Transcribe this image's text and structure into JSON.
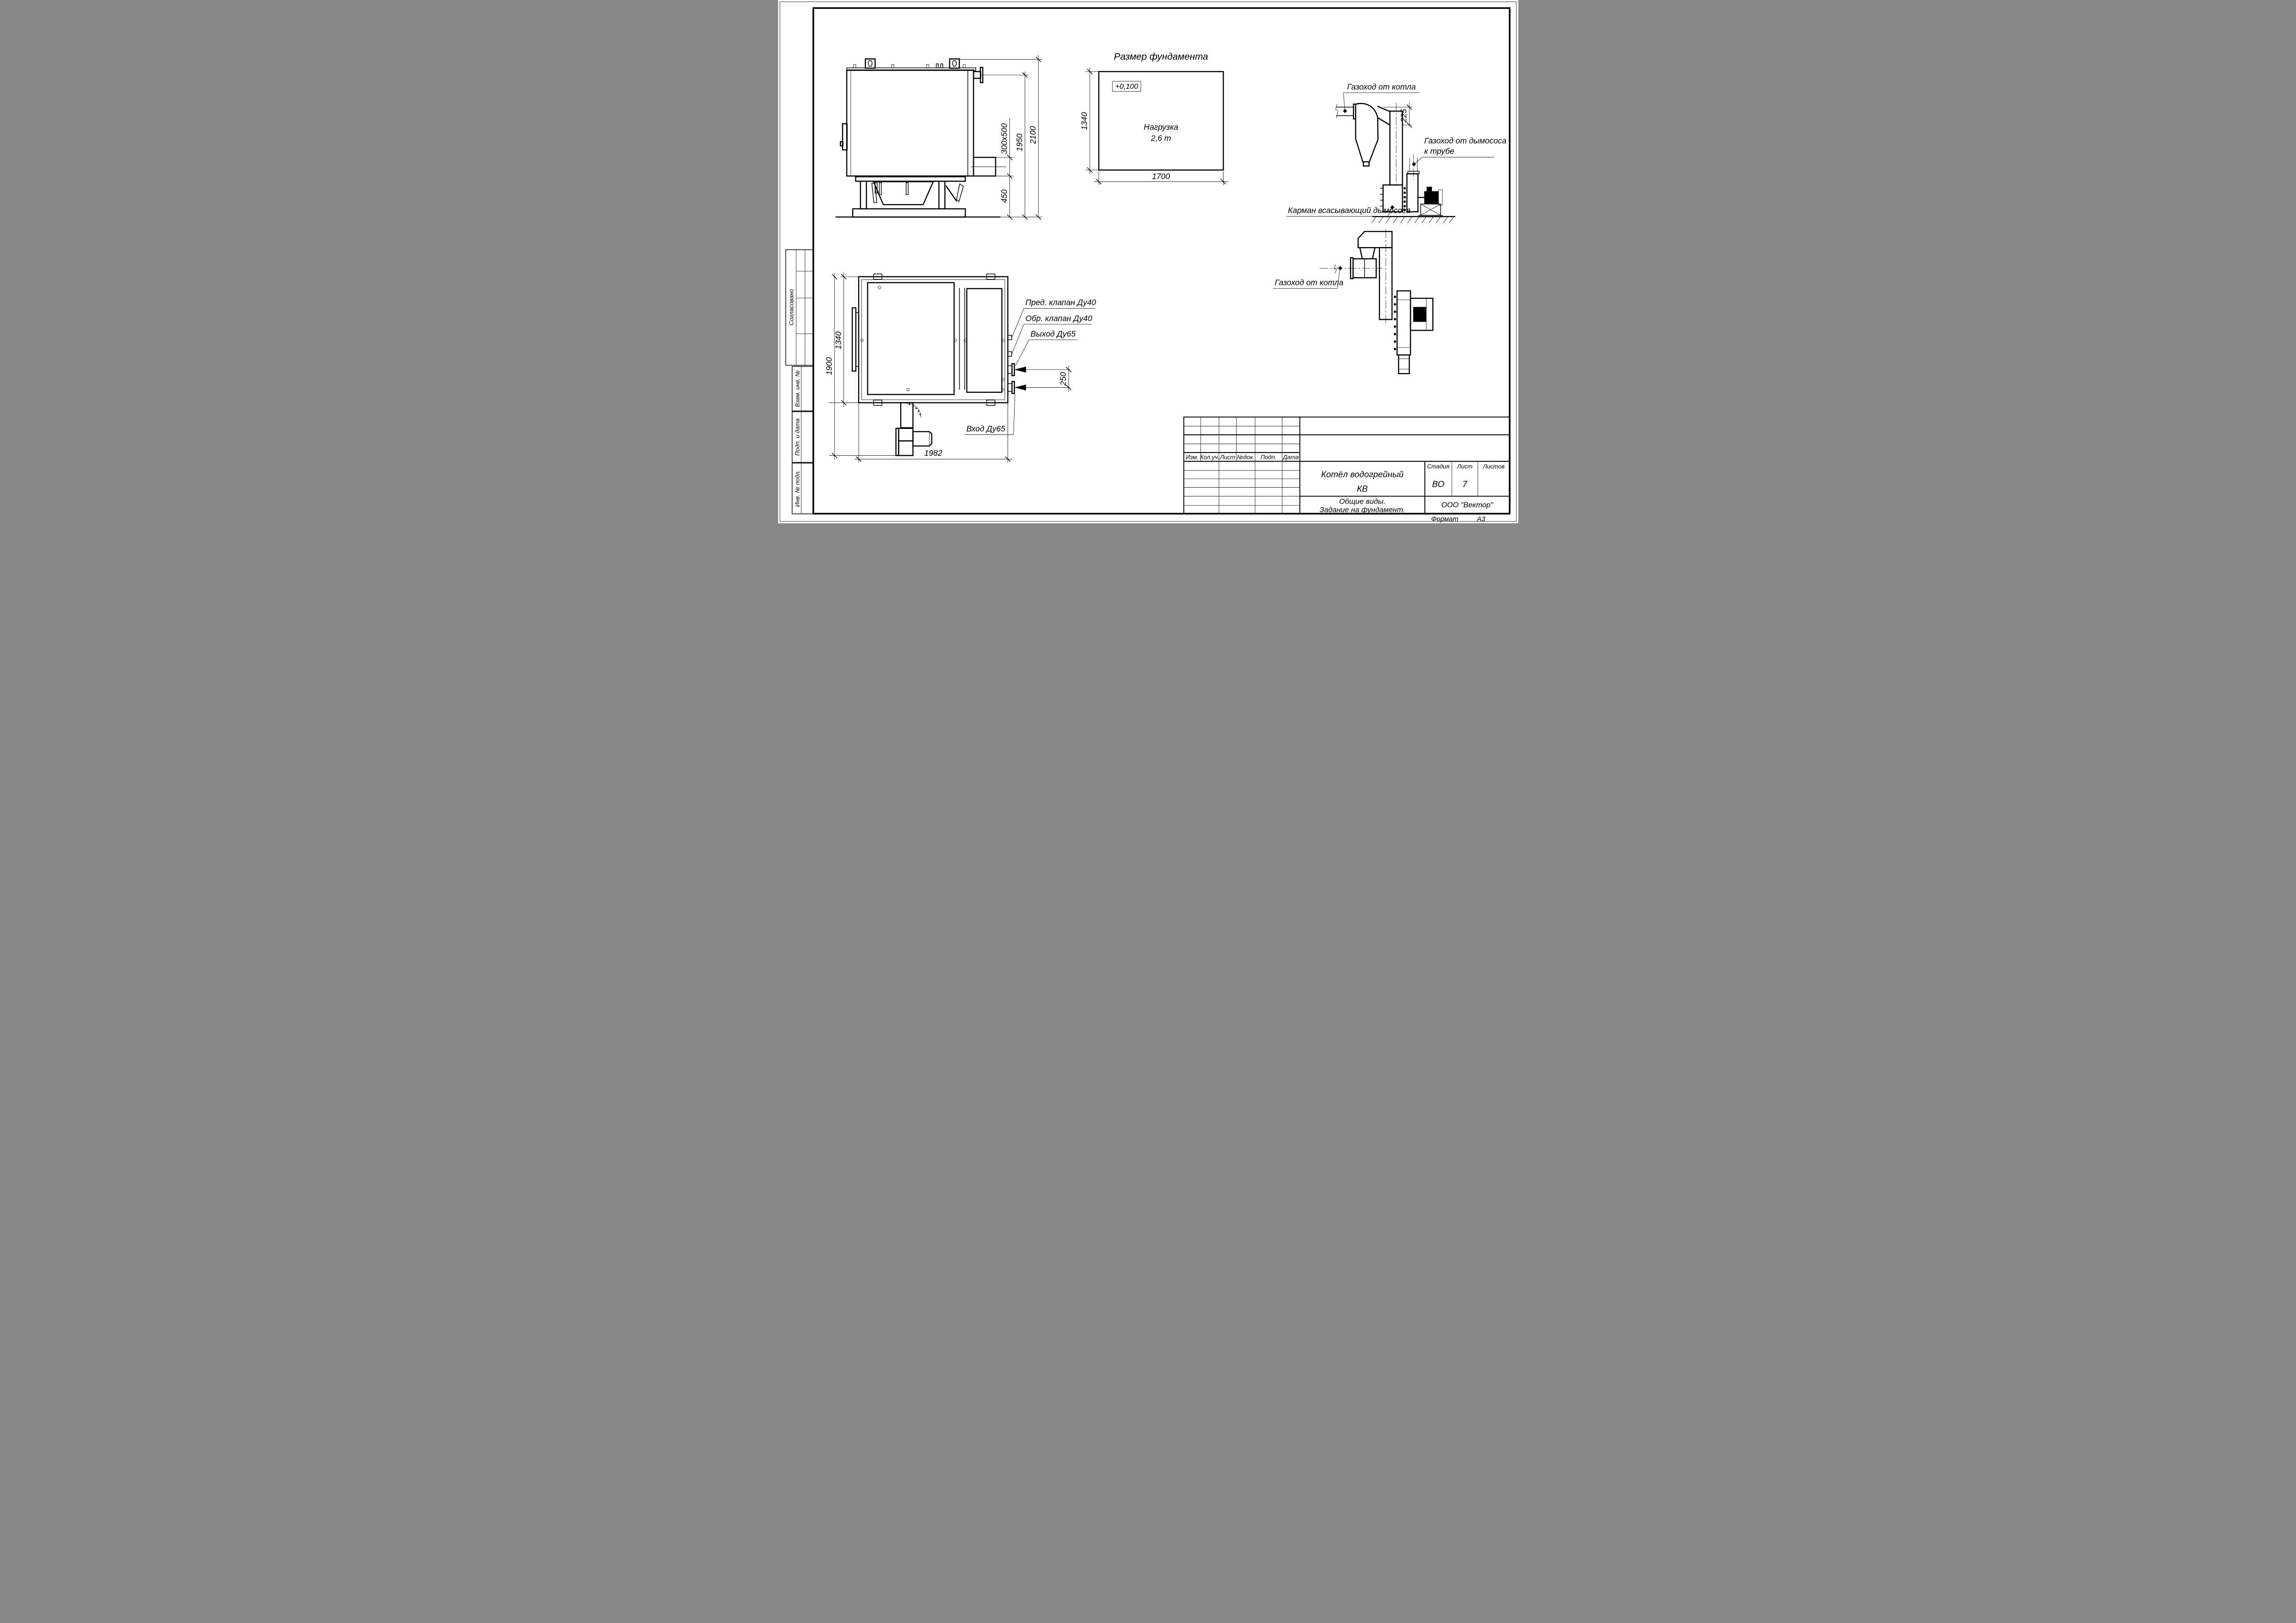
{
  "sheet": {
    "format_label": "Формат",
    "format_value": "А3"
  },
  "foundation": {
    "title": "Размер фундамента",
    "mark": "+0,100",
    "load1": "Нагрузка",
    "load2": "2,6 т",
    "dim_h": "1340",
    "dim_w": "1700"
  },
  "side": {
    "dim_total": "2100",
    "dim_flange": "1950",
    "dim_opening": "300х500",
    "dim_base": "450"
  },
  "plan": {
    "dim_len": "1982",
    "dim_outer": "1900",
    "dim_inner": "1340",
    "dim_noz": "250",
    "lbl_safety": "Пред. клапан Ду40",
    "lbl_check": "Обр. клапан Ду40",
    "lbl_out": "Выход Ду65",
    "lbl_in": "Вход Ду65"
  },
  "flue": {
    "lbl_boiler": "Газоход от котла",
    "dim_225": "225",
    "lbl_fan1": "Газоход от дымососа",
    "lbl_fan2": "к трубе",
    "lbl_pocket": "Карман всасывающий дымососа"
  },
  "flue_plan": {
    "lbl_boiler": "Газоход от котла"
  },
  "tb": {
    "cols": [
      "Изм.",
      "Кол.уч.",
      "Лист",
      "№док.",
      "Подп.",
      "Дата"
    ],
    "title1": "Котёл водогрейный",
    "title2": "КВ",
    "sub1": "Общие виды.",
    "sub2": "Задание на фундамент.",
    "stage_l": "Стадия",
    "sheet_l": "Лист",
    "sheets_l": "Листов",
    "stage_v": "ВО",
    "sheet_v": "7",
    "company": "ООО \"Вектор\""
  },
  "sb": {
    "agreed": "Согласовано",
    "vzam": "Взам. инв. №",
    "podp": "Подп. и дата",
    "inv": "Инв. № подл."
  }
}
